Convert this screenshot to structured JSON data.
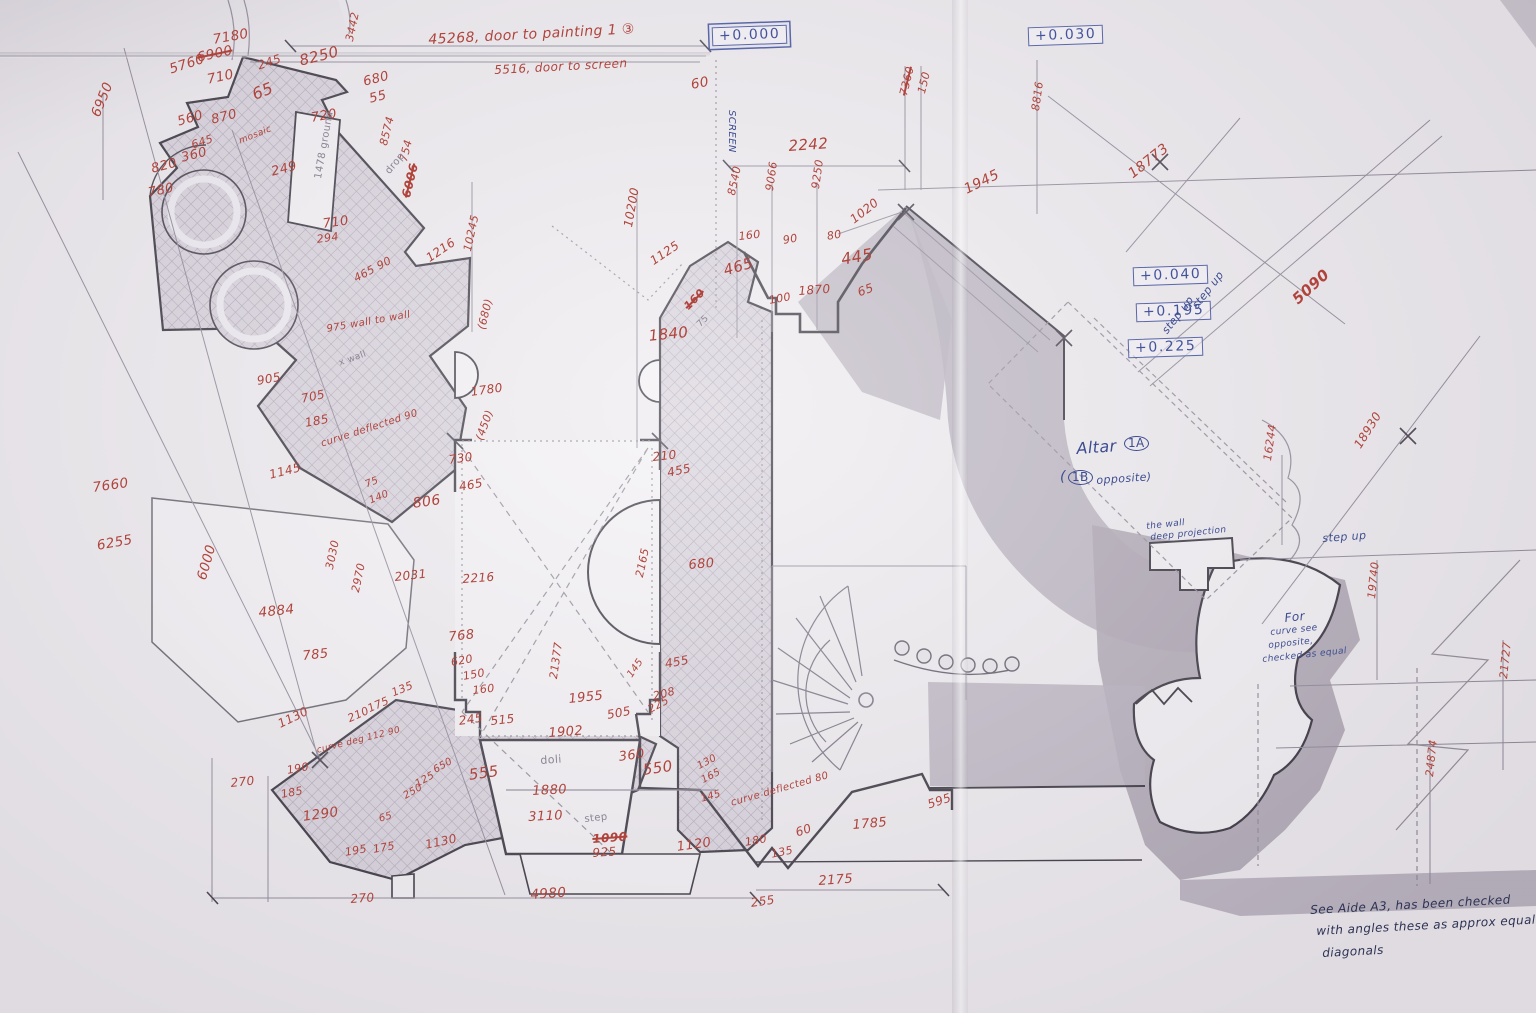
{
  "palette": {
    "red": "#b0443c",
    "blue": "#3d4d90",
    "pencil": "#8b8594",
    "ink": "#2d3254",
    "paper": "#edeaee",
    "gray": "#aea7b4",
    "hatch_line": "#a89fb0"
  },
  "levels": [
    {
      "label": "+0.000",
      "x": 712,
      "y": 26,
      "double": true
    },
    {
      "label": "+0.030",
      "x": 1028,
      "y": 26,
      "double": false
    },
    {
      "label": "+0.040",
      "x": 1133,
      "y": 266,
      "double": false
    },
    {
      "label": "+0.195",
      "x": 1136,
      "y": 302,
      "double": false
    },
    {
      "label": "+0.225",
      "x": 1128,
      "y": 338,
      "double": false
    }
  ],
  "annotations": [
    {
      "t": "7180",
      "x": 212,
      "y": 34,
      "r": -10
    },
    {
      "t": "6900",
      "x": 196,
      "y": 52,
      "r": -12,
      "strike": true
    },
    {
      "t": "5760",
      "x": 168,
      "y": 64,
      "r": -18
    },
    {
      "t": "710",
      "x": 206,
      "y": 74,
      "r": -12
    },
    {
      "t": "245",
      "x": 256,
      "y": 60,
      "r": -18,
      "fs": 12
    },
    {
      "t": "8250",
      "x": 298,
      "y": 54,
      "r": -14,
      "fs": 15
    },
    {
      "t": "3442",
      "x": 344,
      "y": 40,
      "r": -78,
      "fs": 11
    },
    {
      "t": "680",
      "x": 362,
      "y": 76,
      "r": -14,
      "fs": 13
    },
    {
      "t": "55",
      "x": 368,
      "y": 93,
      "r": -14,
      "fs": 13
    },
    {
      "t": "65",
      "x": 250,
      "y": 88,
      "r": -22,
      "fs": 16
    },
    {
      "t": "6950",
      "x": 90,
      "y": 114,
      "r": -68
    },
    {
      "t": "560",
      "x": 176,
      "y": 116,
      "r": -16,
      "fs": 13
    },
    {
      "t": "870",
      "x": 210,
      "y": 114,
      "r": -14,
      "fs": 13
    },
    {
      "t": "720",
      "x": 310,
      "y": 112,
      "r": -10,
      "fs": 13
    },
    {
      "t": "645",
      "x": 190,
      "y": 140,
      "r": -18,
      "fs": 11
    },
    {
      "t": "360",
      "x": 180,
      "y": 152,
      "r": -14,
      "fs": 13
    },
    {
      "t": "820",
      "x": 150,
      "y": 163,
      "r": -14,
      "fs": 13
    },
    {
      "t": "780",
      "x": 147,
      "y": 187,
      "r": -12,
      "fs": 13
    },
    {
      "t": "249",
      "x": 270,
      "y": 166,
      "r": -14,
      "fs": 13
    },
    {
      "t": "mosaic",
      "x": 238,
      "y": 138,
      "r": -22,
      "fs": 9
    },
    {
      "t": "8574",
      "x": 378,
      "y": 144,
      "r": -76,
      "fs": 11
    },
    {
      "t": "754",
      "x": 398,
      "y": 160,
      "r": -76,
      "fs": 11
    },
    {
      "t": "6006",
      "x": 400,
      "y": 196,
      "r": -76,
      "strike": true,
      "bold": true,
      "fs": 12
    },
    {
      "t": "drop",
      "x": 384,
      "y": 170,
      "r": -50,
      "c": "pencil",
      "fs": 10
    },
    {
      "t": "1478 ground",
      "x": 314,
      "y": 178,
      "r": -80,
      "c": "pencil",
      "fs": 10
    },
    {
      "t": "710",
      "x": 322,
      "y": 218,
      "r": -8,
      "fs": 13
    },
    {
      "t": "294",
      "x": 316,
      "y": 234,
      "r": -8,
      "fs": 11
    },
    {
      "t": "1216",
      "x": 424,
      "y": 254,
      "r": -34,
      "fs": 12
    },
    {
      "t": "10245",
      "x": 462,
      "y": 250,
      "r": -78,
      "fs": 11
    },
    {
      "t": "465 90",
      "x": 352,
      "y": 274,
      "r": -28,
      "fs": 11
    },
    {
      "t": "975 wall to wall",
      "x": 326,
      "y": 325,
      "r": -10,
      "fs": 10
    },
    {
      "t": "x wall",
      "x": 338,
      "y": 360,
      "r": -20,
      "c": "pencil",
      "fs": 9
    },
    {
      "t": "905",
      "x": 256,
      "y": 375,
      "r": -10,
      "fs": 12
    },
    {
      "t": "705",
      "x": 300,
      "y": 393,
      "r": -12,
      "fs": 12
    },
    {
      "t": "185",
      "x": 304,
      "y": 417,
      "r": -10,
      "fs": 12
    },
    {
      "t": "curve deflected 90",
      "x": 320,
      "y": 440,
      "r": -18,
      "fs": 10
    },
    {
      "t": "1145",
      "x": 268,
      "y": 469,
      "r": -14,
      "fs": 12
    },
    {
      "t": "75",
      "x": 364,
      "y": 481,
      "r": -22,
      "fs": 10
    },
    {
      "t": "140",
      "x": 368,
      "y": 497,
      "r": -22,
      "fs": 10
    },
    {
      "t": "806",
      "x": 412,
      "y": 497,
      "r": -8,
      "fs": 14
    },
    {
      "t": "730",
      "x": 448,
      "y": 454,
      "r": -8,
      "fs": 12
    },
    {
      "t": "465",
      "x": 458,
      "y": 481,
      "r": -10,
      "fs": 12
    },
    {
      "t": "(680)",
      "x": 476,
      "y": 328,
      "r": -76,
      "fs": 11
    },
    {
      "t": "1780",
      "x": 470,
      "y": 386,
      "r": -8,
      "fs": 12
    },
    {
      "t": "(450)",
      "x": 474,
      "y": 438,
      "r": -70,
      "fs": 11
    },
    {
      "t": "7660",
      "x": 92,
      "y": 482,
      "r": -8
    },
    {
      "t": "6255",
      "x": 96,
      "y": 540,
      "r": -10
    },
    {
      "t": "6000",
      "x": 196,
      "y": 578,
      "r": -74
    },
    {
      "t": "4884",
      "x": 258,
      "y": 607,
      "r": -6
    },
    {
      "t": "785",
      "x": 302,
      "y": 650,
      "r": -6,
      "fs": 13
    },
    {
      "t": "3030",
      "x": 324,
      "y": 568,
      "r": -78,
      "fs": 11
    },
    {
      "t": "2970",
      "x": 350,
      "y": 591,
      "r": -78,
      "fs": 11
    },
    {
      "t": "2031",
      "x": 394,
      "y": 571,
      "r": -6,
      "fs": 12
    },
    {
      "t": "2216",
      "x": 462,
      "y": 573,
      "r": -4,
      "fs": 12
    },
    {
      "t": "768",
      "x": 448,
      "y": 631,
      "r": -6,
      "fs": 13
    },
    {
      "t": "1130",
      "x": 276,
      "y": 719,
      "r": -26,
      "fs": 12
    },
    {
      "t": "270",
      "x": 230,
      "y": 777,
      "r": -6,
      "fs": 12
    },
    {
      "t": "190",
      "x": 286,
      "y": 765,
      "r": -10,
      "fs": 11
    },
    {
      "t": "185",
      "x": 280,
      "y": 789,
      "r": -10,
      "fs": 11
    },
    {
      "t": "1290",
      "x": 302,
      "y": 811,
      "r": -8
    },
    {
      "t": "195",
      "x": 344,
      "y": 847,
      "r": -10,
      "fs": 11
    },
    {
      "t": "175",
      "x": 372,
      "y": 844,
      "r": -10,
      "fs": 11
    },
    {
      "t": "210",
      "x": 346,
      "y": 714,
      "r": -24,
      "fs": 11
    },
    {
      "t": "175",
      "x": 366,
      "y": 704,
      "r": -24,
      "fs": 11
    },
    {
      "t": "135",
      "x": 390,
      "y": 688,
      "r": -22,
      "fs": 11
    },
    {
      "t": "curve deg 112 90",
      "x": 316,
      "y": 747,
      "r": -14,
      "fs": 9
    },
    {
      "t": "250",
      "x": 402,
      "y": 793,
      "r": -30,
      "fs": 10
    },
    {
      "t": "125",
      "x": 414,
      "y": 781,
      "r": -30,
      "fs": 10
    },
    {
      "t": "650",
      "x": 432,
      "y": 767,
      "r": -30,
      "fs": 10
    },
    {
      "t": "65",
      "x": 378,
      "y": 815,
      "r": -16,
      "fs": 10
    },
    {
      "t": "1130",
      "x": 424,
      "y": 839,
      "r": -12,
      "fs": 12
    },
    {
      "t": "270",
      "x": 350,
      "y": 893,
      "r": -4,
      "fs": 12
    },
    {
      "t": "4980",
      "x": 530,
      "y": 889,
      "r": -4
    },
    {
      "t": "620",
      "x": 450,
      "y": 657,
      "r": -10,
      "fs": 11
    },
    {
      "t": "150",
      "x": 462,
      "y": 671,
      "r": -10,
      "fs": 11
    },
    {
      "t": "160",
      "x": 472,
      "y": 685,
      "r": -6,
      "fs": 11
    },
    {
      "t": "245",
      "x": 458,
      "y": 715,
      "r": -8,
      "fs": 12
    },
    {
      "t": "515",
      "x": 490,
      "y": 715,
      "r": -6,
      "fs": 12
    },
    {
      "t": "21377",
      "x": 548,
      "y": 678,
      "r": -82,
      "fs": 11
    },
    {
      "t": "1955",
      "x": 568,
      "y": 693,
      "r": -6,
      "fs": 13
    },
    {
      "t": "505",
      "x": 606,
      "y": 709,
      "r": -10,
      "fs": 12
    },
    {
      "t": "225",
      "x": 646,
      "y": 705,
      "r": -28,
      "fs": 11
    },
    {
      "t": "145",
      "x": 626,
      "y": 674,
      "r": -55,
      "fs": 10
    },
    {
      "t": "455",
      "x": 664,
      "y": 658,
      "r": -10,
      "fs": 12
    },
    {
      "t": "208",
      "x": 652,
      "y": 691,
      "r": -14,
      "fs": 11
    },
    {
      "t": "1902",
      "x": 548,
      "y": 727,
      "r": -4,
      "fs": 13
    },
    {
      "t": "doli",
      "x": 540,
      "y": 755,
      "r": -4,
      "c": "pencil",
      "fs": 11
    },
    {
      "t": "360",
      "x": 618,
      "y": 751,
      "r": -8,
      "fs": 13
    },
    {
      "t": "555",
      "x": 468,
      "y": 768,
      "r": -8,
      "fs": 15
    },
    {
      "t": "1880",
      "x": 532,
      "y": 785,
      "r": -3,
      "fs": 13
    },
    {
      "t": "550",
      "x": 642,
      "y": 763,
      "r": -8,
      "fs": 15
    },
    {
      "t": "3110",
      "x": 528,
      "y": 811,
      "r": -3,
      "fs": 13
    },
    {
      "t": "step",
      "x": 584,
      "y": 815,
      "r": -6,
      "c": "pencil",
      "fs": 10
    },
    {
      "t": "130",
      "x": 696,
      "y": 763,
      "r": -28,
      "fs": 10
    },
    {
      "t": "165",
      "x": 700,
      "y": 777,
      "r": -28,
      "fs": 10
    },
    {
      "t": "145",
      "x": 700,
      "y": 795,
      "r": -16,
      "fs": 10
    },
    {
      "t": "1090",
      "x": 592,
      "y": 833,
      "r": -4,
      "strike": true,
      "bold": true,
      "fs": 12
    },
    {
      "t": "925",
      "x": 592,
      "y": 847,
      "r": -4,
      "fs": 12
    },
    {
      "t": "1120",
      "x": 676,
      "y": 841,
      "r": -8,
      "fs": 13
    },
    {
      "t": "curve deflected 80",
      "x": 730,
      "y": 799,
      "r": -16,
      "fs": 10
    },
    {
      "t": "180",
      "x": 744,
      "y": 837,
      "r": -10,
      "fs": 11
    },
    {
      "t": "60",
      "x": 794,
      "y": 827,
      "r": -18,
      "fs": 12
    },
    {
      "t": "135",
      "x": 770,
      "y": 849,
      "r": -12,
      "fs": 11
    },
    {
      "t": "255",
      "x": 750,
      "y": 897,
      "r": -8,
      "fs": 12
    },
    {
      "t": "2175",
      "x": 818,
      "y": 875,
      "r": -4,
      "fs": 13
    },
    {
      "t": "1785",
      "x": 852,
      "y": 819,
      "r": -5,
      "fs": 13
    },
    {
      "t": "595",
      "x": 926,
      "y": 799,
      "r": -18,
      "fs": 12
    },
    {
      "t": "45268, door to painting 1 ③",
      "x": 428,
      "y": 33,
      "r": -3,
      "fs": 14
    },
    {
      "t": "5516, door to screen",
      "x": 494,
      "y": 64,
      "r": -3,
      "fs": 12
    },
    {
      "t": "60",
      "x": 690,
      "y": 79,
      "r": -10
    },
    {
      "t": "SCREEN",
      "x": 736,
      "y": 110,
      "r": 90,
      "c": "blue",
      "fs": 10
    },
    {
      "t": "10200",
      "x": 622,
      "y": 226,
      "r": -80,
      "fs": 12
    },
    {
      "t": "1125",
      "x": 648,
      "y": 257,
      "r": -34,
      "fs": 12
    },
    {
      "t": "8540",
      "x": 726,
      "y": 194,
      "r": -78,
      "fs": 11
    },
    {
      "t": "9066",
      "x": 764,
      "y": 190,
      "r": -82,
      "fs": 11
    },
    {
      "t": "9250",
      "x": 810,
      "y": 188,
      "r": -82,
      "fs": 11
    },
    {
      "t": "160",
      "x": 738,
      "y": 231,
      "r": -6,
      "fs": 11
    },
    {
      "t": "465",
      "x": 722,
      "y": 264,
      "r": -16,
      "fs": 15
    },
    {
      "t": "90",
      "x": 782,
      "y": 235,
      "r": -10,
      "fs": 11
    },
    {
      "t": "100",
      "x": 768,
      "y": 295,
      "r": -10,
      "fs": 11
    },
    {
      "t": "1870",
      "x": 798,
      "y": 285,
      "r": -4,
      "fs": 12
    },
    {
      "t": "80",
      "x": 826,
      "y": 231,
      "r": -10,
      "fs": 11
    },
    {
      "t": "445",
      "x": 840,
      "y": 252,
      "r": -10,
      "fs": 16
    },
    {
      "t": "1020",
      "x": 848,
      "y": 216,
      "r": -38,
      "fs": 12
    },
    {
      "t": "65",
      "x": 856,
      "y": 287,
      "r": -20,
      "fs": 12
    },
    {
      "t": "1840",
      "x": 648,
      "y": 329,
      "r": -6,
      "fs": 15
    },
    {
      "t": "160",
      "x": 682,
      "y": 304,
      "r": -45,
      "strike": true,
      "bold": true,
      "fs": 11
    },
    {
      "t": "75",
      "x": 696,
      "y": 323,
      "r": -45,
      "c": "pencil",
      "fs": 9
    },
    {
      "t": "210",
      "x": 652,
      "y": 451,
      "r": -6,
      "fs": 12
    },
    {
      "t": "455",
      "x": 666,
      "y": 467,
      "r": -12,
      "fs": 12
    },
    {
      "t": "680",
      "x": 688,
      "y": 559,
      "r": -5,
      "fs": 13
    },
    {
      "t": "2165",
      "x": 634,
      "y": 576,
      "r": -78,
      "fs": 11
    },
    {
      "t": "2242",
      "x": 788,
      "y": 139,
      "r": -4,
      "fs": 15
    },
    {
      "t": "7360",
      "x": 898,
      "y": 94,
      "r": -76,
      "strike": true,
      "fs": 11
    },
    {
      "t": "150",
      "x": 916,
      "y": 92,
      "r": -76,
      "fs": 11
    },
    {
      "t": "8816",
      "x": 1030,
      "y": 110,
      "r": -82,
      "fs": 11
    },
    {
      "t": "1945",
      "x": 962,
      "y": 184,
      "r": -26,
      "fs": 14
    },
    {
      "t": "18773",
      "x": 1126,
      "y": 170,
      "r": -38,
      "fs": 14
    },
    {
      "t": "5090",
      "x": 1290,
      "y": 296,
      "r": -42,
      "fs": 15,
      "bold": true
    },
    {
      "t": "18930",
      "x": 1352,
      "y": 444,
      "r": -58,
      "fs": 12
    },
    {
      "t": "16244",
      "x": 1262,
      "y": 460,
      "r": -82,
      "fs": 11
    },
    {
      "t": "19740",
      "x": 1366,
      "y": 598,
      "r": -84,
      "fs": 11
    },
    {
      "t": "21727",
      "x": 1498,
      "y": 678,
      "r": -84,
      "fs": 11
    },
    {
      "t": "24874",
      "x": 1424,
      "y": 776,
      "r": -84,
      "fs": 11
    },
    {
      "t": "step up",
      "x": 1190,
      "y": 304,
      "r": -52,
      "c": "blue",
      "fs": 11
    },
    {
      "t": "step up",
      "x": 1160,
      "y": 329,
      "r": -52,
      "c": "blue",
      "fs": 11
    },
    {
      "t": "step up",
      "x": 1322,
      "y": 533,
      "r": -4,
      "c": "blue",
      "fs": 11
    },
    {
      "t": "the wall",
      "x": 1146,
      "y": 523,
      "r": -6,
      "c": "blue",
      "fs": 9
    },
    {
      "t": "deep projection",
      "x": 1150,
      "y": 534,
      "r": -6,
      "c": "blue",
      "fs": 9
    },
    {
      "t": "Altar",
      "x": 1076,
      "y": 441,
      "r": -4,
      "c": "blue",
      "fs": 16
    },
    {
      "t": "1A",
      "x": 1124,
      "y": 436,
      "r": 0,
      "c": "blue",
      "fs": 12,
      "circled": true
    },
    {
      "t": "(",
      "x": 1060,
      "y": 470,
      "r": 0,
      "c": "blue",
      "fs": 14
    },
    {
      "t": "1B",
      "x": 1068,
      "y": 470,
      "r": 0,
      "c": "blue",
      "fs": 12,
      "circled": true
    },
    {
      "t": "opposite)",
      "x": 1096,
      "y": 475,
      "r": -4,
      "c": "blue",
      "fs": 11
    },
    {
      "t": "For",
      "x": 1284,
      "y": 612,
      "r": -6,
      "c": "blue",
      "fs": 12
    },
    {
      "t": "curve see",
      "x": 1270,
      "y": 629,
      "r": -6,
      "c": "blue",
      "fs": 9
    },
    {
      "t": "opposite,",
      "x": 1268,
      "y": 642,
      "r": -6,
      "c": "blue",
      "fs": 9
    },
    {
      "t": "checked as equal",
      "x": 1262,
      "y": 656,
      "r": -6,
      "c": "blue",
      "fs": 9
    },
    {
      "t": "See Aide A3, has been checked",
      "x": 1310,
      "y": 904,
      "r": -3,
      "c": "ink",
      "fs": 12
    },
    {
      "t": "with angles these as approx equal",
      "x": 1316,
      "y": 925,
      "r": -3,
      "c": "ink",
      "fs": 12
    },
    {
      "t": "diagonals",
      "x": 1322,
      "y": 947,
      "r": -3,
      "c": "ink",
      "fs": 12
    }
  ]
}
